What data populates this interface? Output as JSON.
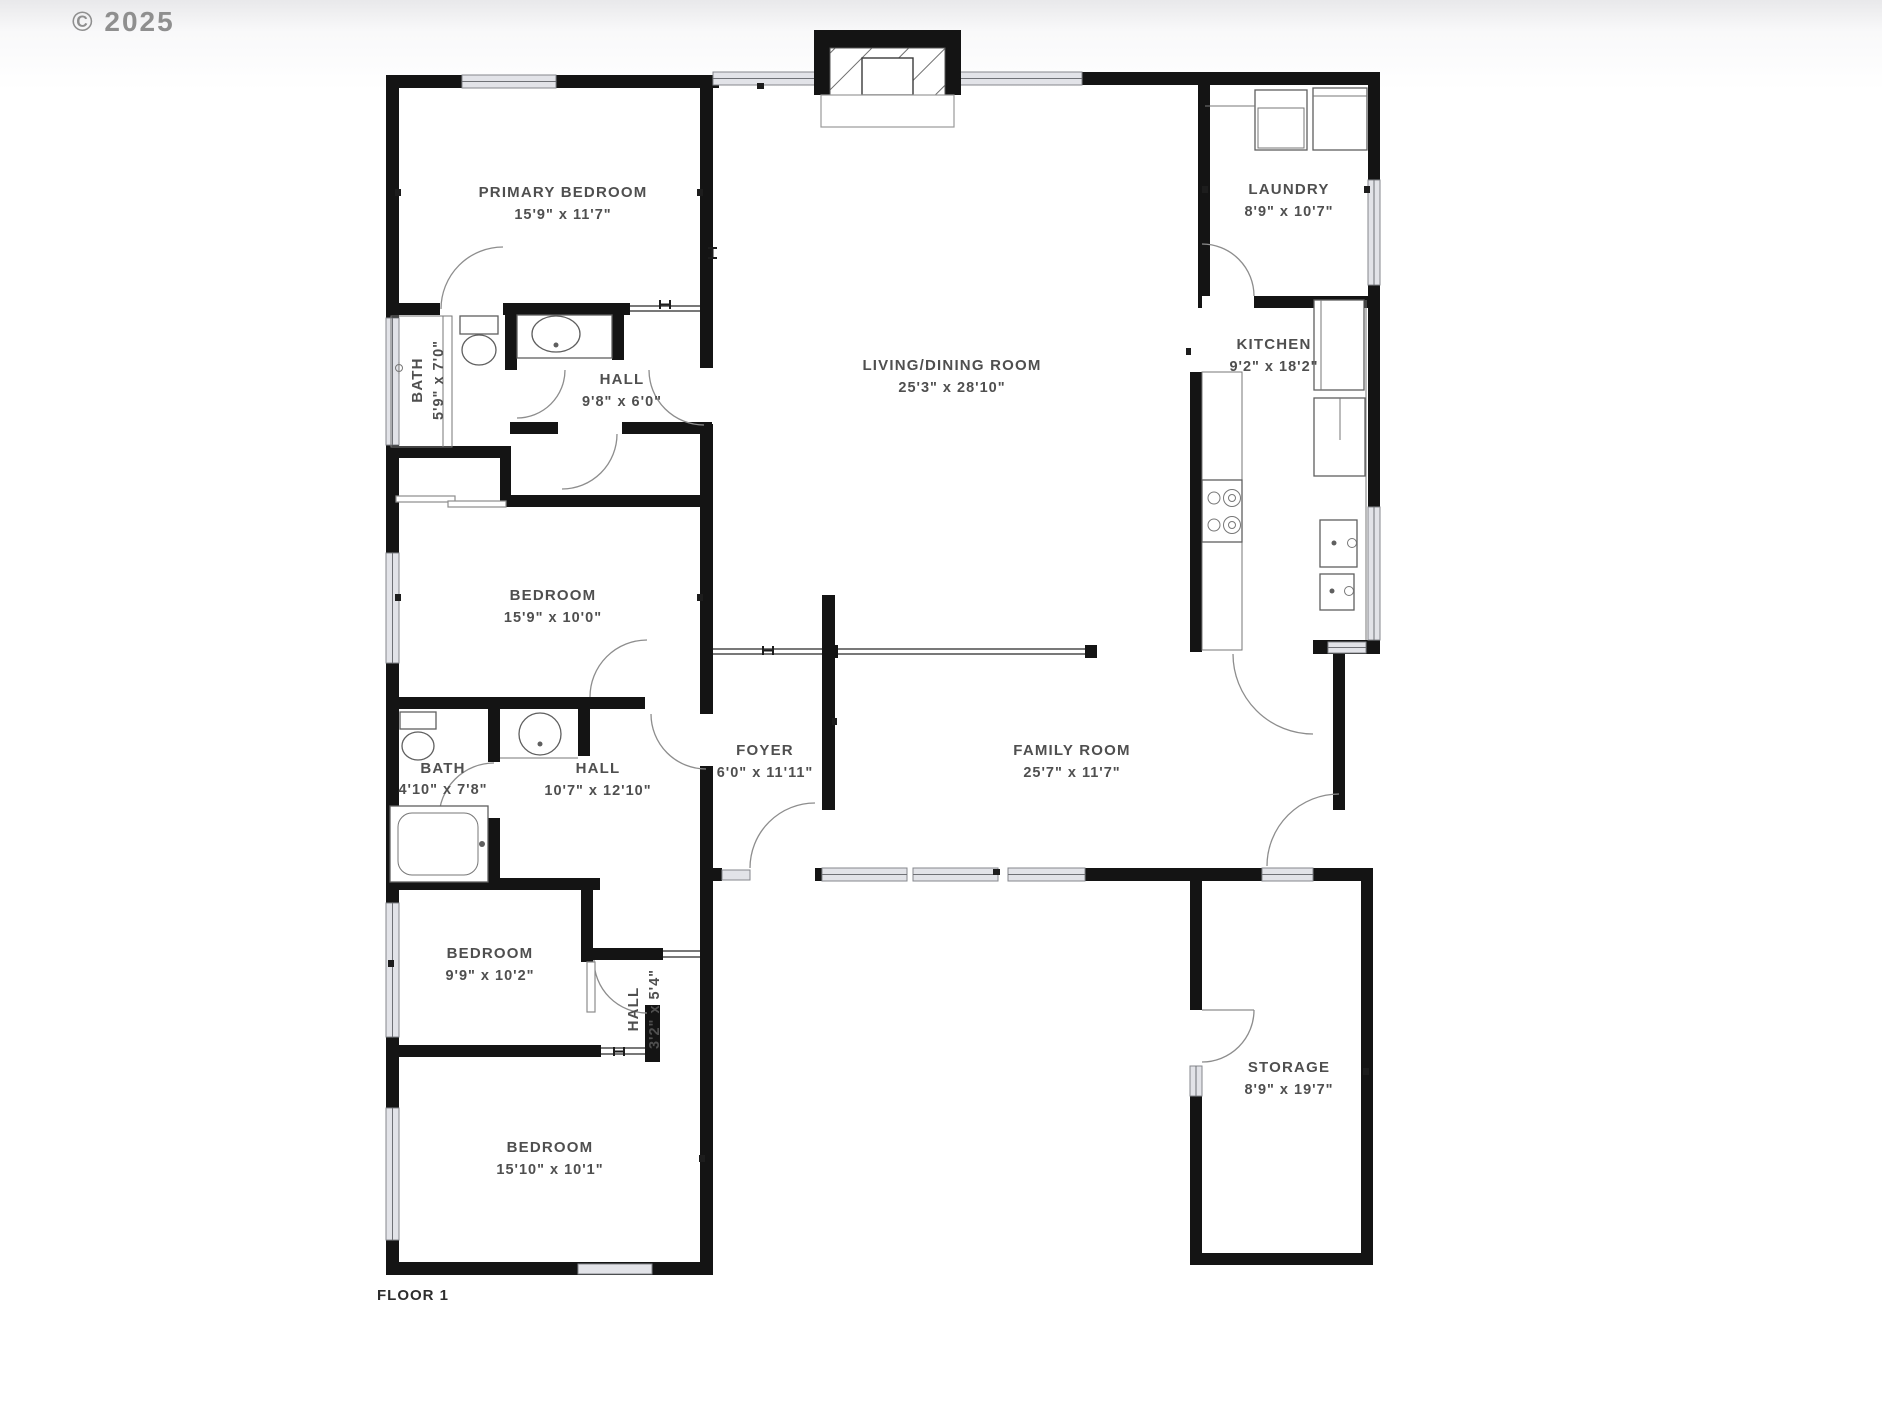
{
  "watermark": "© 2025",
  "floor_label": "FLOOR 1",
  "rooms": {
    "primary_bedroom": {
      "name": "PRIMARY BEDROOM",
      "dims": "15'9\" x 11'7\""
    },
    "bath_primary": {
      "name": "BATH",
      "dims": "5'9\" x 7'0\""
    },
    "hall_primary": {
      "name": "HALL",
      "dims": "9'8\" x 6'0\""
    },
    "living_dining": {
      "name": "LIVING/DINING ROOM",
      "dims": "25'3\" x 28'10\""
    },
    "laundry": {
      "name": "LAUNDRY",
      "dims": "8'9\" x 10'7\""
    },
    "kitchen": {
      "name": "KITCHEN",
      "dims": "9'2\" x 18'2\""
    },
    "bedroom_2": {
      "name": "BEDROOM",
      "dims": "15'9\" x 10'0\""
    },
    "bath_hall": {
      "name": "BATH",
      "dims": "4'10\" x 7'8\""
    },
    "hall_center": {
      "name": "HALL",
      "dims": "10'7\" x 12'10\""
    },
    "foyer": {
      "name": "FOYER",
      "dims": "6'0\" x 11'11\""
    },
    "family_room": {
      "name": "FAMILY ROOM",
      "dims": "25'7\" x 11'7\""
    },
    "bedroom_3": {
      "name": "BEDROOM",
      "dims": "9'9\" x 10'2\""
    },
    "hall_small": {
      "name": "HALL",
      "dims": "3'2\" x 5'4\""
    },
    "bedroom_4": {
      "name": "BEDROOM",
      "dims": "15'10\" x 10'1\""
    },
    "storage": {
      "name": "STORAGE",
      "dims": "8'9\" x 19'7\""
    }
  },
  "colors": {
    "wall": "#141414",
    "window": "#e2e3e8",
    "label": "#4f4f4f",
    "watermark": "#8f8f8f"
  }
}
